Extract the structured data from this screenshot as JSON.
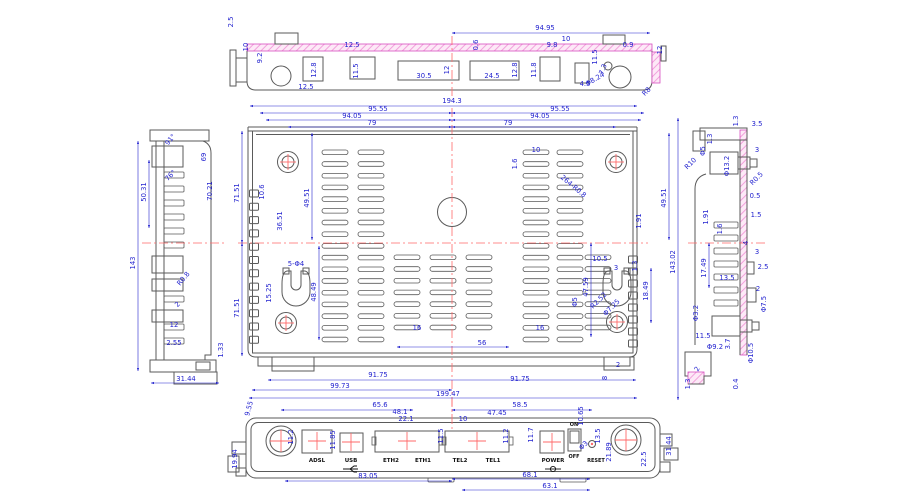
{
  "drawing": {
    "title": "router enclosure machining drawing",
    "colors": {
      "dimension": "#2323cf",
      "outline": "#5a5a5a",
      "hatch_stroke": "#d84fc0",
      "hatch_fill": "#f2a0dc",
      "centerline": "#ff6a6a",
      "label": "#111111"
    },
    "views": {
      "top_edge": {
        "dims": [
          {
            "t": "2.5",
            "x": 233,
            "y": 22,
            "r": -90
          },
          {
            "t": "10",
            "x": 248,
            "y": 47,
            "r": -90
          },
          {
            "t": "9.2",
            "x": 262,
            "y": 58,
            "r": -90
          },
          {
            "t": "94.95",
            "x": 545,
            "y": 30,
            "l": [
              452,
              33,
              650,
              33
            ]
          },
          {
            "t": "12.5",
            "x": 352,
            "y": 47
          },
          {
            "t": "12.8",
            "x": 316,
            "y": 70,
            "r": -90
          },
          {
            "t": "12.5",
            "x": 306,
            "y": 89
          },
          {
            "t": "11.5",
            "x": 358,
            "y": 71,
            "r": -90
          },
          {
            "t": "30.5",
            "x": 424,
            "y": 78
          },
          {
            "t": "12",
            "x": 449,
            "y": 70,
            "r": -90
          },
          {
            "t": "24.5",
            "x": 492,
            "y": 78
          },
          {
            "t": "12.8",
            "x": 517,
            "y": 70,
            "r": -90
          },
          {
            "t": "0.6",
            "x": 478,
            "y": 45,
            "r": -90
          },
          {
            "t": "10",
            "x": 566,
            "y": 41
          },
          {
            "t": "9.8",
            "x": 552,
            "y": 47
          },
          {
            "t": "11.8",
            "x": 536,
            "y": 70,
            "r": -90
          },
          {
            "t": "11.5",
            "x": 597,
            "y": 57,
            "r": -90
          },
          {
            "t": "0.9",
            "x": 628,
            "y": 47
          },
          {
            "t": "7.3",
            "x": 605,
            "y": 70,
            "r": -70
          },
          {
            "t": "4.5",
            "x": 585,
            "y": 86
          },
          {
            "t": "Φ8.24",
            "x": 596,
            "y": 81,
            "r": -30
          },
          {
            "t": "R8",
            "x": 648,
            "y": 93,
            "r": -45
          },
          {
            "t": "12",
            "x": 662,
            "y": 50,
            "r": -90
          }
        ]
      },
      "left_profile": {
        "dims": [
          {
            "t": "91°",
            "x": 172,
            "y": 141,
            "r": -50
          },
          {
            "t": "69",
            "x": 206,
            "y": 157,
            "r": -90
          },
          {
            "t": "76°",
            "x": 172,
            "y": 177,
            "r": -45
          },
          {
            "t": "70.21",
            "x": 212,
            "y": 191,
            "r": -90
          },
          {
            "t": "50.31",
            "x": 146,
            "y": 192,
            "r": -90,
            "l": [
              149,
              160,
              149,
              228
            ]
          },
          {
            "t": "143",
            "x": 135,
            "y": 263,
            "r": -90,
            "l": [
              138,
              141,
              138,
              371
            ]
          },
          {
            "t": "R0.8",
            "x": 185,
            "y": 280,
            "r": -50
          },
          {
            "t": "2",
            "x": 179,
            "y": 306,
            "r": -45
          },
          {
            "t": "12",
            "x": 174,
            "y": 327
          },
          {
            "t": "2.55",
            "x": 174,
            "y": 345
          },
          {
            "t": "1.33",
            "x": 223,
            "y": 350,
            "r": -90
          },
          {
            "t": "31.44",
            "x": 186,
            "y": 381,
            "l": [
              151,
              383,
              219,
              383
            ]
          }
        ]
      },
      "plan": {
        "dims": [
          {
            "t": "194.3",
            "x": 452,
            "y": 103,
            "l": [
              250,
              106,
              637,
              106
            ]
          },
          {
            "t": "95.55",
            "x": 378,
            "y": 111,
            "l": [
              260,
              113,
              452,
              113
            ]
          },
          {
            "t": "95.55",
            "x": 560,
            "y": 111,
            "l": [
              452,
              113,
              644,
              113
            ]
          },
          {
            "t": "94.05",
            "x": 352,
            "y": 118,
            "l": [
              266,
              120,
              452,
              120
            ]
          },
          {
            "t": "94.05",
            "x": 540,
            "y": 118,
            "l": [
              452,
              120,
              641,
              120
            ]
          },
          {
            "t": "79",
            "x": 372,
            "y": 125,
            "l": [
              288,
              127,
              452,
              127
            ]
          },
          {
            "t": "79",
            "x": 508,
            "y": 125,
            "l": [
              452,
              127,
              616,
              127
            ]
          },
          {
            "t": "71.51",
            "x": 239,
            "y": 193,
            "r": -90,
            "l": [
              242,
              131,
              242,
              243
            ]
          },
          {
            "t": "71.51",
            "x": 239,
            "y": 308,
            "r": -90,
            "l": [
              242,
              243,
              242,
              356
            ]
          },
          {
            "t": "10.6",
            "x": 264,
            "y": 192,
            "r": -90
          },
          {
            "t": "36.51",
            "x": 282,
            "y": 221,
            "r": -90
          },
          {
            "t": "49.51",
            "x": 309,
            "y": 198,
            "r": -90,
            "l": [
              312,
              133,
              312,
              240
            ]
          },
          {
            "t": "15.25",
            "x": 271,
            "y": 293,
            "r": -90
          },
          {
            "t": "5-Φ4",
            "x": 296,
            "y": 266
          },
          {
            "t": "48.49",
            "x": 316,
            "y": 292,
            "r": -90,
            "l": [
              319,
              246,
              319,
              340
            ]
          },
          {
            "t": "10",
            "x": 536,
            "y": 152
          },
          {
            "t": "1.6",
            "x": 517,
            "y": 164,
            "r": -90
          },
          {
            "t": "264-R0.8",
            "x": 572,
            "y": 188,
            "r": 40
          },
          {
            "t": "49.51",
            "x": 666,
            "y": 198,
            "r": -90,
            "l": [
              669,
              133,
              669,
              240
            ]
          },
          {
            "t": "1.91",
            "x": 641,
            "y": 221,
            "r": -90
          },
          {
            "t": "143.02",
            "x": 675,
            "y": 262,
            "r": -90,
            "l": [
              678,
              118,
              678,
              400
            ]
          },
          {
            "t": "10.5",
            "x": 600,
            "y": 261
          },
          {
            "t": "3",
            "x": 616,
            "y": 270
          },
          {
            "t": "1.3",
            "x": 637,
            "y": 266,
            "r": -90
          },
          {
            "t": "47.59",
            "x": 588,
            "y": 287,
            "r": -90,
            "l": [
              591,
              243,
              591,
              337
            ]
          },
          {
            "t": "Φ5",
            "x": 577,
            "y": 302,
            "r": -90
          },
          {
            "t": "R2.52",
            "x": 600,
            "y": 302,
            "r": -45
          },
          {
            "t": "Φ7.25",
            "x": 613,
            "y": 309,
            "r": -45
          },
          {
            "t": "18.49",
            "x": 648,
            "y": 291,
            "r": -90,
            "l": [
              651,
              268,
              651,
              323
            ]
          },
          {
            "t": "16",
            "x": 417,
            "y": 330
          },
          {
            "t": "16",
            "x": 540,
            "y": 330
          },
          {
            "t": "56",
            "x": 482,
            "y": 345,
            "l": [
              397,
              347,
              509,
              347
            ]
          },
          {
            "t": "91.75",
            "x": 378,
            "y": 377
          },
          {
            "t": "91.75",
            "x": 520,
            "y": 381,
            "l": [
              268,
              380,
              636,
              380
            ]
          },
          {
            "t": "99.73",
            "x": 340,
            "y": 388,
            "l": [
              252,
              390,
              452,
              390
            ]
          },
          {
            "t": "199.47",
            "x": 448,
            "y": 396,
            "l": [
              249,
              398,
              637,
              398
            ]
          },
          {
            "t": "2",
            "x": 618,
            "y": 367
          },
          {
            "t": "8",
            "x": 607,
            "y": 378,
            "r": -90
          }
        ]
      },
      "right_profile": {
        "dims": [
          {
            "t": "1.3",
            "x": 738,
            "y": 121,
            "r": -90
          },
          {
            "t": "3.5",
            "x": 757,
            "y": 126
          },
          {
            "t": "1.3",
            "x": 712,
            "y": 139,
            "r": -90
          },
          {
            "t": "Φ5",
            "x": 705,
            "y": 151,
            "r": -90
          },
          {
            "t": "R10",
            "x": 692,
            "y": 165,
            "r": -45
          },
          {
            "t": "Φ13.2",
            "x": 729,
            "y": 166,
            "r": -90
          },
          {
            "t": "3",
            "x": 757,
            "y": 152
          },
          {
            "t": "R0.5",
            "x": 758,
            "y": 180,
            "r": -45
          },
          {
            "t": "0.5",
            "x": 755,
            "y": 198
          },
          {
            "t": "1.91",
            "x": 708,
            "y": 217,
            "r": -90
          },
          {
            "t": "1.5",
            "x": 756,
            "y": 217
          },
          {
            "t": "1.6",
            "x": 722,
            "y": 229,
            "r": -90
          },
          {
            "t": "4",
            "x": 748,
            "y": 243,
            "r": -90
          },
          {
            "t": "3",
            "x": 757,
            "y": 254
          },
          {
            "t": "17.49",
            "x": 706,
            "y": 268,
            "r": -90,
            "l": [
              709,
              243,
              709,
              288
            ]
          },
          {
            "t": "2.5",
            "x": 763,
            "y": 269
          },
          {
            "t": "13.5",
            "x": 727,
            "y": 280
          },
          {
            "t": "2",
            "x": 758,
            "y": 291
          },
          {
            "t": "Φ7.5",
            "x": 766,
            "y": 304,
            "r": -90
          },
          {
            "t": "Φ3.2",
            "x": 698,
            "y": 313,
            "r": -90
          },
          {
            "t": "11.5",
            "x": 703,
            "y": 338
          },
          {
            "t": "Φ9.2",
            "x": 715,
            "y": 349
          },
          {
            "t": "3.7",
            "x": 730,
            "y": 344,
            "r": -90
          },
          {
            "t": "Φ10.5",
            "x": 753,
            "y": 353,
            "r": -90
          },
          {
            "t": "2",
            "x": 699,
            "y": 370,
            "r": -60
          },
          {
            "t": "1.3",
            "x": 690,
            "y": 384,
            "r": -90
          },
          {
            "t": "0.4",
            "x": 738,
            "y": 384,
            "r": -90
          }
        ]
      },
      "front_panel": {
        "dims": [
          {
            "t": "9.55",
            "x": 251,
            "y": 409,
            "r": -75
          },
          {
            "t": "65.6",
            "x": 380,
            "y": 407,
            "l": [
              281,
              410,
              413,
              410
            ]
          },
          {
            "t": "48.1",
            "x": 400,
            "y": 414
          },
          {
            "t": "22.1",
            "x": 406,
            "y": 421
          },
          {
            "t": "10",
            "x": 463,
            "y": 421
          },
          {
            "t": "58.5",
            "x": 520,
            "y": 407,
            "l": [
              452,
              410,
              592,
              410
            ]
          },
          {
            "t": "47.45",
            "x": 497,
            "y": 415
          },
          {
            "t": "10.65",
            "x": 583,
            "y": 416,
            "r": -90
          },
          {
            "t": "11.2",
            "x": 293,
            "y": 437,
            "r": -90
          },
          {
            "t": "11.85",
            "x": 335,
            "y": 440,
            "r": -90
          },
          {
            "t": "11.5",
            "x": 443,
            "y": 436,
            "r": -90
          },
          {
            "t": "11.2",
            "x": 508,
            "y": 436,
            "r": -90
          },
          {
            "t": "11.7",
            "x": 533,
            "y": 435,
            "r": -90
          },
          {
            "t": "13.5",
            "x": 600,
            "y": 436,
            "r": -90
          },
          {
            "t": "Φ3",
            "x": 585,
            "y": 447,
            "r": -45
          },
          {
            "t": "21.89",
            "x": 611,
            "y": 452,
            "r": -90
          },
          {
            "t": "22.5",
            "x": 646,
            "y": 459,
            "r": -90
          },
          {
            "t": "31.44",
            "x": 671,
            "y": 446,
            "r": -90
          },
          {
            "t": "19.94",
            "x": 237,
            "y": 459,
            "r": -90
          },
          {
            "t": "83.05",
            "x": 368,
            "y": 478,
            "l": [
              285,
              481,
              452,
              481
            ]
          },
          {
            "t": "68.1",
            "x": 530,
            "y": 477,
            "l": [
              452,
              479,
              590,
              479
            ]
          },
          {
            "t": "63.1",
            "x": 550,
            "y": 488,
            "l": [
              462,
              490,
              590,
              490
            ]
          }
        ],
        "ports": [
          {
            "label": "ADSL",
            "x": 317
          },
          {
            "label": "USB",
            "x": 351
          },
          {
            "label": "ETH2",
            "x": 391
          },
          {
            "label": "ETH1",
            "x": 423
          },
          {
            "label": "TEL2",
            "x": 460
          },
          {
            "label": "TEL1",
            "x": 493
          },
          {
            "label": "POWER",
            "x": 553
          }
        ],
        "switch_on": "ON",
        "switch_off": "OFF",
        "reset_label": "RESET"
      }
    }
  }
}
